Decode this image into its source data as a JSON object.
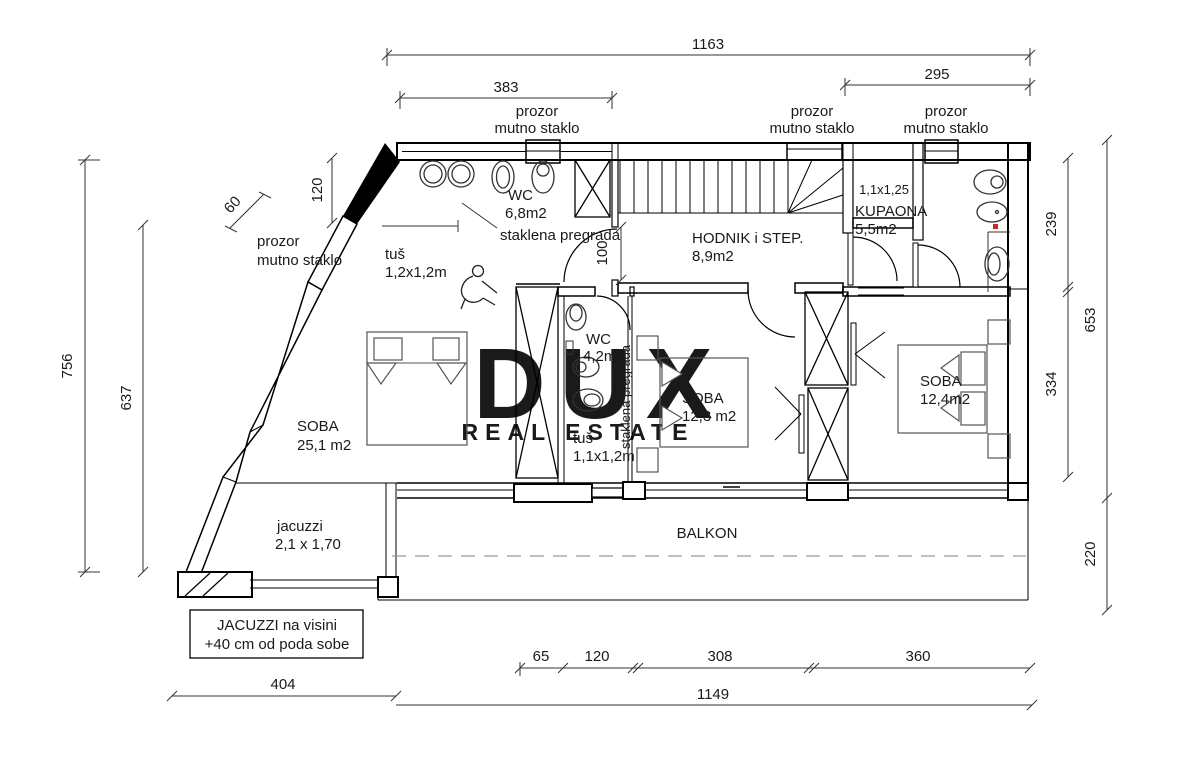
{
  "watermark": {
    "line1": "DUX",
    "line2": "REAL ESTATE"
  },
  "window_label": {
    "line1": "prozor",
    "line2": "mutno staklo"
  },
  "rooms": {
    "wc_top": {
      "name": "WC",
      "area": "6,8m2"
    },
    "hodnik": {
      "name": "HODNIK i STEP.",
      "area": "8,9m2"
    },
    "shower_room": {
      "size": "1,1x1,25"
    },
    "kupaona": {
      "name": "KUPAONA",
      "area": "5,5m2"
    },
    "soba_large": {
      "name": "SOBA",
      "area": "25,1 m2"
    },
    "wc_mid": {
      "name": "WC",
      "area": "4,2m2"
    },
    "soba_mid": {
      "name": "SOBA",
      "area": "12,3 m2"
    },
    "soba_right": {
      "name": "SOBA",
      "area": "12,4m2"
    },
    "balkon": {
      "name": "BALKON"
    },
    "jacuzzi": {
      "name": "jacuzzi",
      "size": "2,1 x 1,70"
    }
  },
  "partitions": {
    "glass_h": "staklena pregrada",
    "glass_v": "staklena pregrada"
  },
  "showers": {
    "tus_large": {
      "name": "tuš",
      "size": "1,2x1,2m"
    },
    "tus_small": {
      "name": "tuš",
      "size": "1,1x1,2m"
    }
  },
  "note": {
    "line1": "JACUZZI na visini",
    "line2": "+40 cm od poda sobe"
  },
  "dimensions": {
    "top_total": "1163",
    "top_left": "383",
    "top_right": "295",
    "left_outer": "756",
    "left_inner": "637",
    "wall_60": "60",
    "window_120": "120",
    "door_100": "100",
    "right_239": "239",
    "right_334": "334",
    "right_653": "653",
    "right_220": "220",
    "bottom_65": "65",
    "bottom_120": "120",
    "bottom_308": "308",
    "bottom_360": "360",
    "bottom_404": "404",
    "bottom_1149": "1149"
  },
  "colors": {
    "marker_red": "#cc2a1e",
    "watermark_big": "#e9e9e9",
    "watermark_small": "#ececec"
  }
}
